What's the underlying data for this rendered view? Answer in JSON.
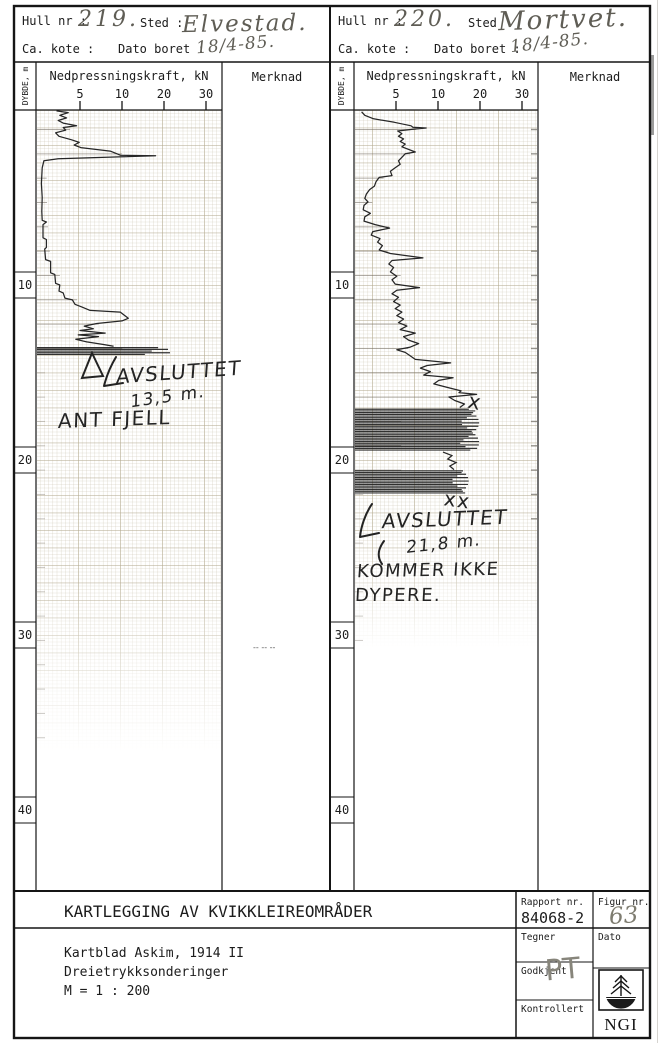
{
  "panels": [
    {
      "hull_nr_label": "Hull nr :",
      "hull_nr": "219.",
      "sted_label": "Sted :",
      "sted": "Elvestad.",
      "kote_label": "Ca. kote :",
      "dato_label": "Dato boret :",
      "dato": "18/4-85.",
      "depth_axis_label": "DYBDE, m",
      "force_axis_label": "Nedpressningskraft, kN",
      "merknad_label": "Merknad",
      "ticks": [
        "5",
        "10",
        "20",
        "30"
      ],
      "depth_labels": [
        "10",
        "20",
        "30",
        "40"
      ],
      "annotation": {
        "line1": "AVSLUTTET",
        "line2": "13,5 m.",
        "line3": "ANT FJELL"
      },
      "merknad_note": "-- -- --"
    },
    {
      "hull_nr_label": "Hull nr :",
      "hull_nr": "220.",
      "sted_label": "Sted",
      "sted": "Mortvet.",
      "kote_label": "Ca. kote :",
      "dato_label": "Dato boret :",
      "dato": "18/4-85.",
      "depth_axis_label": "DYBDE, m",
      "force_axis_label": "Nedpressningskraft, kN",
      "merknad_label": "Merknad",
      "ticks": [
        "5",
        "10",
        "20",
        "30"
      ],
      "depth_labels": [
        "10",
        "20",
        "30",
        "40"
      ],
      "annotation": {
        "line1": "AVSLUTTET",
        "line2": "21,8 m.",
        "line3": "KOMMER IKKE",
        "line4": "DYPERE."
      },
      "x_mark": "x",
      "xx_mark": "xx"
    }
  ],
  "footer": {
    "title": "KARTLEGGING AV KVIKKLEIREOMRÅDER",
    "line1": "Kartblad Askim, 1914 II",
    "line2": "Dreietrykksonderinger",
    "line3": "M = 1 : 200",
    "rapport_label": "Rapport nr.",
    "rapport_value": "84068-2",
    "figur_label": "Figur nr.",
    "figur_value": "63",
    "tegner_label": "Tegner",
    "dato_label": "Dato",
    "godkjent_label": "Godkjent",
    "godkjent_sign": "PT",
    "kontrollert_label": "Kontrollert",
    "logo_text": "NGI"
  },
  "chart_data": [
    {
      "type": "line",
      "title": "Hull nr 219, Elvestad - dreietrykksondering",
      "xlabel": "Nedpressningskraft, kN",
      "ylabel": "DYBDE, m",
      "x_ticks": [
        5,
        10,
        20,
        30
      ],
      "depth_ticks": [
        10,
        20,
        30,
        40
      ],
      "ylim": [
        0,
        44
      ],
      "end_depth": 13.5,
      "end_note": "Avsluttet 13,5 m. Ant fjell",
      "points": [
        [
          0.05,
          2.2
        ],
        [
          0.15,
          3.6
        ],
        [
          0.3,
          2.6
        ],
        [
          0.45,
          3.4
        ],
        [
          0.6,
          2.4
        ],
        [
          0.75,
          3.0
        ],
        [
          0.9,
          4.6
        ],
        [
          1.0,
          3.0
        ],
        [
          1.15,
          3.3
        ],
        [
          1.3,
          2.1
        ],
        [
          1.5,
          2.5
        ],
        [
          1.7,
          4.0
        ],
        [
          1.85,
          4.9
        ],
        [
          2.0,
          4.3
        ],
        [
          2.15,
          5.1
        ],
        [
          2.35,
          8.6
        ],
        [
          2.5,
          9.4
        ],
        [
          2.58,
          9.8
        ],
        [
          2.62,
          18.0
        ],
        [
          2.68,
          9.6
        ],
        [
          2.78,
          2.4
        ],
        [
          2.9,
          0.7
        ],
        [
          3.3,
          0.5
        ],
        [
          4.2,
          0.4
        ],
        [
          5.0,
          0.5
        ],
        [
          5.8,
          0.45
        ],
        [
          6.3,
          0.5
        ],
        [
          6.4,
          1.0
        ],
        [
          6.55,
          0.6
        ],
        [
          7.3,
          0.6
        ],
        [
          7.4,
          1.0
        ],
        [
          7.85,
          1.0
        ],
        [
          7.95,
          0.8
        ],
        [
          8.55,
          0.9
        ],
        [
          8.65,
          1.5
        ],
        [
          9.3,
          1.5
        ],
        [
          9.4,
          2.0
        ],
        [
          9.9,
          2.1
        ],
        [
          10.0,
          2.6
        ],
        [
          10.35,
          2.5
        ],
        [
          10.45,
          3.0
        ],
        [
          10.75,
          3.2
        ],
        [
          10.85,
          4.1
        ],
        [
          11.1,
          4.4
        ],
        [
          11.25,
          5.2
        ],
        [
          11.45,
          6.2
        ],
        [
          11.55,
          9.8
        ],
        [
          11.7,
          10.4
        ],
        [
          11.9,
          11.5
        ],
        [
          12.05,
          10.0
        ],
        [
          12.2,
          7.0
        ],
        [
          12.35,
          5.5
        ],
        [
          12.5,
          6.6
        ],
        [
          12.6,
          5.0
        ],
        [
          12.75,
          8.0
        ],
        [
          12.85,
          4.8
        ],
        [
          12.95,
          7.2
        ],
        [
          13.1,
          4.5
        ],
        [
          13.25,
          5.8
        ],
        [
          13.4,
          7.8
        ],
        [
          13.5,
          9.0
        ]
      ],
      "bands": [
        {
          "d1": 13.58,
          "d2": 13.98,
          "kn_min": 12,
          "kn_max": 21.5
        }
      ],
      "grid_bottom_px": 752,
      "fade_from_px": 580
    },
    {
      "type": "line",
      "title": "Hull nr 220, Mortvet - dreietrykksondering",
      "xlabel": "Nedpressningskraft, kN",
      "ylabel": "DYBDE, m",
      "x_ticks": [
        5,
        10,
        20,
        30
      ],
      "depth_ticks": [
        10,
        20,
        30,
        40
      ],
      "ylim": [
        0,
        44
      ],
      "end_depth": 21.8,
      "end_note": "Avsluttet 21,8 m. Kommer ikke dypere.",
      "points": [
        [
          0.1,
          0.7
        ],
        [
          0.3,
          1.1
        ],
        [
          0.5,
          2.2
        ],
        [
          0.7,
          4.8
        ],
        [
          0.9,
          6.8
        ],
        [
          0.98,
          7.0
        ],
        [
          1.03,
          8.6
        ],
        [
          1.1,
          7.0
        ],
        [
          1.2,
          5.2
        ],
        [
          1.35,
          5.7
        ],
        [
          1.5,
          5.3
        ],
        [
          1.65,
          5.9
        ],
        [
          1.8,
          5.5
        ],
        [
          1.95,
          6.1
        ],
        [
          2.1,
          5.7
        ],
        [
          2.4,
          7.3
        ],
        [
          2.5,
          6.1
        ],
        [
          2.7,
          5.7
        ],
        [
          2.9,
          5.3
        ],
        [
          3.1,
          5.5
        ],
        [
          3.3,
          4.9
        ],
        [
          3.5,
          4.3
        ],
        [
          3.75,
          4.5
        ],
        [
          3.85,
          2.9
        ],
        [
          4.1,
          2.5
        ],
        [
          4.35,
          2.3
        ],
        [
          4.55,
          1.7
        ],
        [
          4.8,
          1.3
        ],
        [
          5.05,
          1.1
        ],
        [
          5.25,
          1.5
        ],
        [
          5.45,
          1.0
        ],
        [
          5.7,
          0.9
        ],
        [
          5.9,
          1.8
        ],
        [
          6.1,
          1.1
        ],
        [
          6.35,
          1.0
        ],
        [
          6.55,
          2.4
        ],
        [
          6.75,
          4.2
        ],
        [
          6.95,
          2.1
        ],
        [
          7.15,
          1.9
        ],
        [
          7.35,
          3.0
        ],
        [
          7.55,
          2.7
        ],
        [
          7.75,
          3.3
        ],
        [
          8.0,
          2.9
        ],
        [
          8.2,
          4.3
        ],
        [
          8.45,
          8.2
        ],
        [
          8.6,
          4.5
        ],
        [
          8.8,
          4.1
        ],
        [
          9.0,
          4.7
        ],
        [
          9.25,
          4.3
        ],
        [
          9.5,
          5.1
        ],
        [
          9.7,
          4.5
        ],
        [
          9.95,
          4.9
        ],
        [
          10.15,
          7.8
        ],
        [
          10.3,
          5.1
        ],
        [
          10.5,
          4.5
        ],
        [
          10.7,
          5.3
        ],
        [
          10.95,
          4.7
        ],
        [
          11.15,
          5.5
        ],
        [
          11.35,
          4.9
        ],
        [
          11.55,
          5.7
        ],
        [
          11.75,
          5.1
        ],
        [
          11.95,
          5.9
        ],
        [
          12.15,
          5.3
        ],
        [
          12.35,
          6.3
        ],
        [
          12.55,
          5.5
        ],
        [
          12.75,
          7.3
        ],
        [
          12.95,
          5.9
        ],
        [
          13.15,
          6.5
        ],
        [
          13.35,
          7.7
        ],
        [
          13.55,
          6.7
        ],
        [
          13.7,
          5.1
        ],
        [
          13.85,
          6.1
        ],
        [
          14.05,
          6.7
        ],
        [
          14.25,
          7.3
        ],
        [
          14.45,
          13.0
        ],
        [
          14.6,
          8.7
        ],
        [
          14.75,
          7.9
        ],
        [
          14.95,
          9.1
        ],
        [
          15.15,
          8.3
        ],
        [
          15.3,
          13.6
        ],
        [
          15.45,
          10.2
        ],
        [
          15.65,
          9.5
        ],
        [
          15.85,
          12.2
        ],
        [
          16.05,
          15.5
        ],
        [
          16.15,
          15.0
        ],
        [
          16.25,
          19.2
        ],
        [
          16.4,
          12.6
        ],
        [
          16.6,
          14.0
        ],
        [
          16.8,
          16.3
        ],
        [
          17.0,
          15.2
        ]
      ],
      "steps_after_band": [
        [
          19.55,
          11.2
        ],
        [
          19.75,
          13.3
        ],
        [
          19.95,
          12.3
        ],
        [
          20.15,
          14.3
        ],
        [
          20.35,
          12.8
        ],
        [
          20.55,
          13.8
        ]
      ],
      "bands": [
        {
          "d1": 17.1,
          "d2": 19.45,
          "kn_min": 12.5,
          "kn_max": 19.8
        },
        {
          "d1": 20.62,
          "d2": 21.95,
          "kn_min": 10.5,
          "kn_max": 17.3
        }
      ],
      "grid_bottom_px": 648,
      "fade_from_px": 540
    }
  ]
}
